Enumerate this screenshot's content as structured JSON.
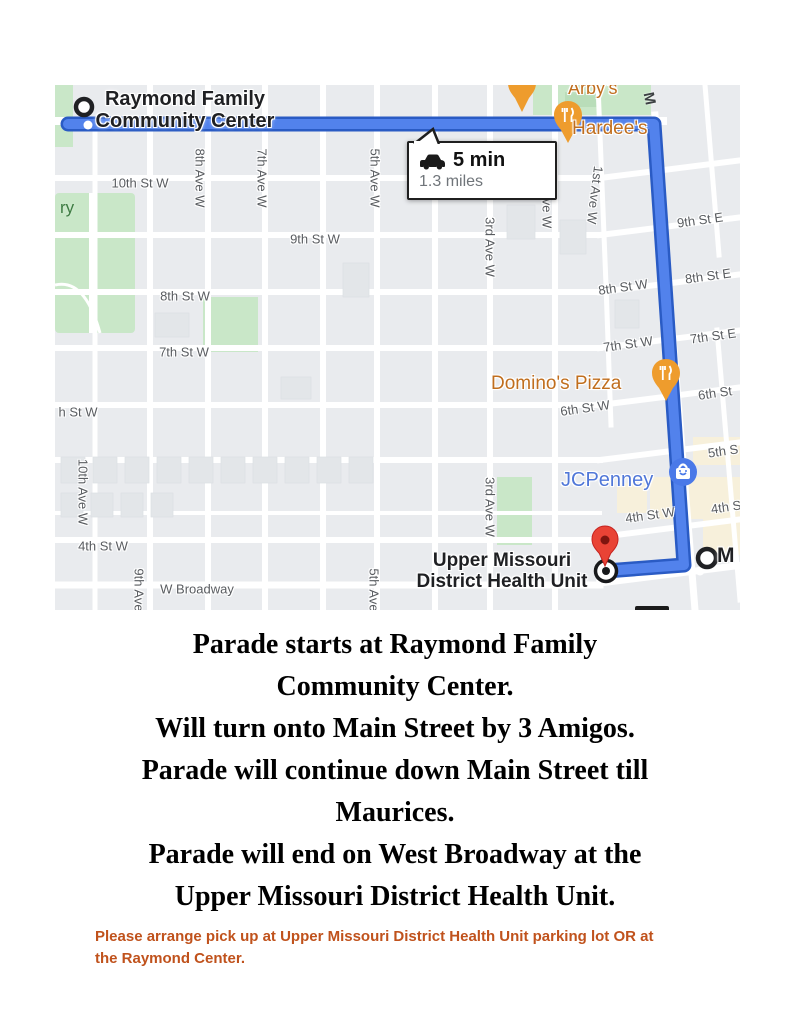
{
  "map": {
    "info_box": {
      "duration": "5 min",
      "distance": "1.3 miles"
    },
    "start_label": [
      "Raymond Family",
      "Community Center"
    ],
    "dest_label": [
      "Upper Missouri",
      "District Health Unit"
    ],
    "pois": {
      "arbys": "Arby's",
      "hardees": "Hardee's",
      "dominos": "Domino's Pizza",
      "jcpenney": "JCPenney",
      "maurices_partial": "M"
    },
    "road_letter": "M",
    "park_label": "ry",
    "street_labels": [
      "10th St W",
      "9th St W",
      "8th St W",
      "7th St W",
      "h St W",
      "4th St W",
      "W Broadway",
      "8th Ave W",
      "7th Ave W",
      "5th Ave W",
      "3rd Ave W",
      "2nd Ave W",
      "1st Ave W",
      "10th Ave W",
      "9th Ave",
      "5th Ave",
      "3rd Ave W",
      "9th St E",
      "8th St W",
      "8th St E",
      "7th St W",
      "7th St E",
      "6th St W",
      "6th St",
      "5th S",
      "4th St W",
      "4th S"
    ],
    "colors": {
      "route_blue": "#5282EC",
      "route_casing": "#2A5BC4",
      "poi_orange_text": "#C06E1E",
      "poi_pin_orange": "#EE9C2D",
      "jcpenney_blue": "#5077D8",
      "destination_red": "#E94335",
      "park_green": "#C9E7C8",
      "note_orange": "#C0521C"
    }
  },
  "instructions": {
    "paragraphs": [
      [
        "Parade starts at Raymond Family",
        "Community Center."
      ],
      [
        "Will turn onto Main Street by 3 Amigos."
      ],
      [
        "Parade will continue down Main Street till",
        "Maurices."
      ],
      [
        "Parade will end on West Broadway at the",
        "Upper Missouri District Health Unit."
      ]
    ],
    "note": [
      "Please arrange pick up at Upper Missouri District Health Unit parking lot OR at",
      "the Raymond Center."
    ]
  }
}
